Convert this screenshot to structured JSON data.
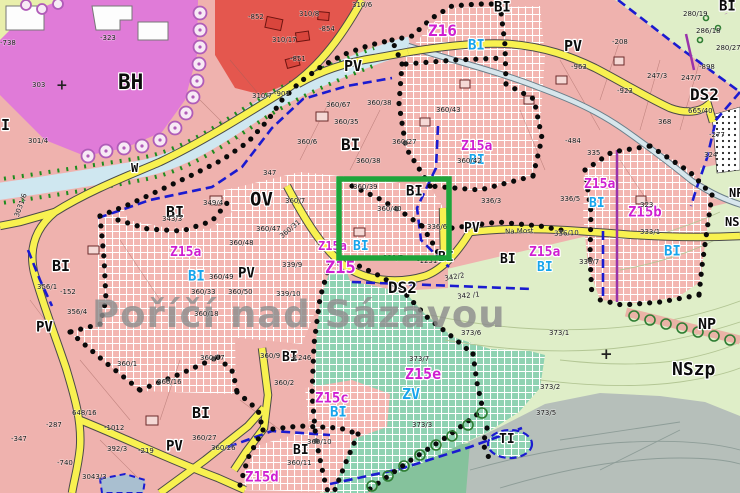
{
  "town_name": "Poříčí nad Sázavou",
  "colors": {
    "residential_pink": "#efb2ae",
    "development_hatch_pink": "#f3b6b1",
    "mixed_red": "#e4574e",
    "civic_violet": "#e07bd8",
    "greenery_teal_hatch": "#8fd2b2",
    "landscape_light_green": "#dfeec8",
    "forest_gray": "#b6bfba",
    "meadow_sage": "#85c29c",
    "road_yellow": "#f8f150",
    "water_blue": "#cfe7f0",
    "boundary_blue": "#1b1bd0",
    "boundary_purple": "#9933aa",
    "boundary_black_dots": "#0a0a0a",
    "label_magenta": "#cf1fd1",
    "label_cyan": "#17a5ec",
    "highlight_green": "#1ea53b",
    "town_name_gray": "#8e8e8e"
  },
  "highlight": {
    "x": 339,
    "y": 179,
    "width": 110,
    "height": 79
  },
  "labels": {
    "zones": [
      {
        "t": "OV",
        "x": 250,
        "y": 192,
        "s": 19
      },
      {
        "t": "BH",
        "x": 118,
        "y": 74,
        "s": 21
      },
      {
        "t": "BI",
        "x": 341,
        "y": 138,
        "s": 16
      },
      {
        "t": "BI",
        "x": 166,
        "y": 206,
        "s": 15
      },
      {
        "t": "BI",
        "x": 52,
        "y": 260,
        "s": 15
      },
      {
        "t": "I",
        "x": 1,
        "y": 119,
        "s": 15
      },
      {
        "t": "BI",
        "x": 719,
        "y": 1,
        "s": 14
      },
      {
        "t": "BI",
        "x": 494,
        "y": 2,
        "s": 14
      },
      {
        "t": "BI",
        "x": 406,
        "y": 186,
        "s": 14
      },
      {
        "t": "BI",
        "x": 438,
        "y": 252,
        "s": 13
      },
      {
        "t": "BI",
        "x": 500,
        "y": 254,
        "s": 13
      },
      {
        "t": "BI",
        "x": 282,
        "y": 352,
        "s": 13
      },
      {
        "t": "BI",
        "x": 192,
        "y": 407,
        "s": 15
      },
      {
        "t": "BI",
        "x": 293,
        "y": 445,
        "s": 13
      },
      {
        "t": "PV",
        "x": 344,
        "y": 60,
        "s": 15
      },
      {
        "t": "PV",
        "x": 564,
        "y": 40,
        "s": 15
      },
      {
        "t": "PV",
        "x": 238,
        "y": 268,
        "s": 14
      },
      {
        "t": "PV",
        "x": 36,
        "y": 322,
        "s": 14
      },
      {
        "t": "PV",
        "x": 464,
        "y": 223,
        "s": 13
      },
      {
        "t": "PV",
        "x": 166,
        "y": 441,
        "s": 14
      },
      {
        "t": "DS2",
        "x": 388,
        "y": 281,
        "s": 16
      },
      {
        "t": "DS2",
        "x": 690,
        "y": 88,
        "s": 16
      },
      {
        "t": "NP",
        "x": 698,
        "y": 318,
        "s": 15
      },
      {
        "t": "NSzp",
        "x": 672,
        "y": 362,
        "s": 18
      },
      {
        "t": "NP",
        "x": 729,
        "y": 188,
        "s": 12
      },
      {
        "t": "NSzp",
        "x": 725,
        "y": 217,
        "s": 12
      },
      {
        "t": "TI",
        "x": 499,
        "y": 434,
        "s": 13
      },
      {
        "t": "W",
        "x": 131,
        "y": 163,
        "s": 12
      }
    ],
    "plans": [
      {
        "t": "Z16",
        "x": 428,
        "y": 24,
        "s": 16
      },
      {
        "t": "Z15a",
        "x": 170,
        "y": 247,
        "s": 13
      },
      {
        "t": "Z15a",
        "x": 461,
        "y": 141,
        "s": 13
      },
      {
        "t": "Z15a",
        "x": 584,
        "y": 179,
        "s": 13
      },
      {
        "t": "Z15a",
        "x": 529,
        "y": 247,
        "s": 13
      },
      {
        "t": "Z15b",
        "x": 628,
        "y": 207,
        "s": 14
      },
      {
        "t": "Z15a",
        "x": 318,
        "y": 241,
        "s": 12
      },
      {
        "t": "Z15",
        "x": 325,
        "y": 261,
        "s": 17
      },
      {
        "t": "Z15c",
        "x": 315,
        "y": 393,
        "s": 14
      },
      {
        "t": "Z15d",
        "x": 245,
        "y": 472,
        "s": 14
      },
      {
        "t": "Z15e",
        "x": 405,
        "y": 368,
        "s": 15
      }
    ],
    "uses": [
      {
        "t": "BI",
        "x": 468,
        "y": 40,
        "s": 14
      },
      {
        "t": "BI",
        "x": 188,
        "y": 271,
        "s": 14
      },
      {
        "t": "BI",
        "x": 469,
        "y": 155,
        "s": 13
      },
      {
        "t": "BI",
        "x": 589,
        "y": 198,
        "s": 13
      },
      {
        "t": "BI",
        "x": 664,
        "y": 246,
        "s": 14
      },
      {
        "t": "BI",
        "x": 537,
        "y": 262,
        "s": 13
      },
      {
        "t": "BI",
        "x": 353,
        "y": 241,
        "s": 13
      },
      {
        "t": "BI",
        "x": 330,
        "y": 407,
        "s": 14
      },
      {
        "t": "ZV",
        "x": 402,
        "y": 388,
        "s": 15
      }
    ],
    "parcels": [
      {
        "t": "303",
        "x": 32,
        "y": 82
      },
      {
        "t": "-323",
        "x": 100,
        "y": 35
      },
      {
        "t": "301/4",
        "x": 28,
        "y": 138
      },
      {
        "t": "-738",
        "x": 0,
        "y": 40
      },
      {
        "t": "310/6",
        "x": 352,
        "y": 2
      },
      {
        "t": "310/8",
        "x": 299,
        "y": 11
      },
      {
        "t": "310/17",
        "x": 272,
        "y": 37
      },
      {
        "t": "-852",
        "x": 248,
        "y": 14
      },
      {
        "t": "-854",
        "x": 319,
        "y": 26
      },
      {
        "t": "-851",
        "x": 290,
        "y": 56
      },
      {
        "t": "-901",
        "x": 274,
        "y": 91
      },
      {
        "t": "310/7",
        "x": 252,
        "y": 93
      },
      {
        "t": "347",
        "x": 263,
        "y": 170
      },
      {
        "t": "360/7",
        "x": 285,
        "y": 198
      },
      {
        "t": "343/3",
        "x": 162,
        "y": 216
      },
      {
        "t": "349/4",
        "x": 203,
        "y": 200
      },
      {
        "t": "360/47",
        "x": 256,
        "y": 226
      },
      {
        "t": "360/48",
        "x": 229,
        "y": 240
      },
      {
        "t": "360/49",
        "x": 209,
        "y": 274
      },
      {
        "t": "360/50",
        "x": 228,
        "y": 289
      },
      {
        "t": "360/33",
        "x": 191,
        "y": 289
      },
      {
        "t": "360/18",
        "x": 194,
        "y": 311
      },
      {
        "t": "339/9",
        "x": 282,
        "y": 262
      },
      {
        "t": "339/10",
        "x": 276,
        "y": 291
      },
      {
        "t": "360/31",
        "x": 279,
        "y": 235,
        "r": -40
      },
      {
        "t": "3031/6",
        "x": 14,
        "y": 216,
        "r": -70
      },
      {
        "t": "360/67",
        "x": 326,
        "y": 102
      },
      {
        "t": "360/38",
        "x": 367,
        "y": 100
      },
      {
        "t": "360/35",
        "x": 334,
        "y": 119
      },
      {
        "t": "360/6",
        "x": 297,
        "y": 139
      },
      {
        "t": "360/27",
        "x": 392,
        "y": 139
      },
      {
        "t": "360/38",
        "x": 356,
        "y": 158
      },
      {
        "t": "360/43",
        "x": 436,
        "y": 107
      },
      {
        "t": "360/42",
        "x": 457,
        "y": 158
      },
      {
        "t": "360/40",
        "x": 377,
        "y": 206
      },
      {
        "t": "360/39",
        "x": 353,
        "y": 184
      },
      {
        "t": "336/6",
        "x": 427,
        "y": 224
      },
      {
        "t": "336/3",
        "x": 481,
        "y": 198
      },
      {
        "t": "335",
        "x": 587,
        "y": 150
      },
      {
        "t": "-963",
        "x": 571,
        "y": 64
      },
      {
        "t": "-208",
        "x": 612,
        "y": 39
      },
      {
        "t": "-923",
        "x": 617,
        "y": 88
      },
      {
        "t": "368",
        "x": 658,
        "y": 119
      },
      {
        "t": "-484",
        "x": 565,
        "y": 138
      },
      {
        "t": "336/5",
        "x": 560,
        "y": 196
      },
      {
        "t": "336/7",
        "x": 579,
        "y": 259
      },
      {
        "t": "323",
        "x": 640,
        "y": 202
      },
      {
        "t": "333/1",
        "x": 640,
        "y": 229
      },
      {
        "t": "280/19",
        "x": 683,
        "y": 11
      },
      {
        "t": "286/18",
        "x": 696,
        "y": 28
      },
      {
        "t": "280/27",
        "x": 716,
        "y": 45
      },
      {
        "t": "247/3",
        "x": 647,
        "y": 73
      },
      {
        "t": "247/7",
        "x": 681,
        "y": 75
      },
      {
        "t": "-898",
        "x": 699,
        "y": 64
      },
      {
        "t": "665/40",
        "x": 688,
        "y": 108
      },
      {
        "t": "-277",
        "x": 709,
        "y": 132
      },
      {
        "t": "324",
        "x": 704,
        "y": 152
      },
      {
        "t": "342/2",
        "x": 444,
        "y": 276,
        "r": -10
      },
      {
        "t": "342 /1",
        "x": 457,
        "y": 294,
        "r": -6
      },
      {
        "t": "339/7",
        "x": 383,
        "y": 255
      },
      {
        "t": "-1231",
        "x": 417,
        "y": 258
      },
      {
        "t": "373/6",
        "x": 461,
        "y": 330
      },
      {
        "t": "373/7",
        "x": 409,
        "y": 356
      },
      {
        "t": "373/1",
        "x": 549,
        "y": 330
      },
      {
        "t": "373/2",
        "x": 540,
        "y": 384
      },
      {
        "t": "373/5",
        "x": 536,
        "y": 410
      },
      {
        "t": "373/3",
        "x": 412,
        "y": 422
      },
      {
        "t": "336/10",
        "x": 554,
        "y": 231,
        "r": -2
      },
      {
        "t": "Na Most",
        "x": 505,
        "y": 229,
        "r": -2
      },
      {
        "t": "356/1",
        "x": 37,
        "y": 284
      },
      {
        "t": "-152",
        "x": 60,
        "y": 289
      },
      {
        "t": "356/4",
        "x": 67,
        "y": 309
      },
      {
        "t": "360/1",
        "x": 117,
        "y": 361
      },
      {
        "t": "360/17",
        "x": 200,
        "y": 355
      },
      {
        "t": "360/16",
        "x": 157,
        "y": 379
      },
      {
        "t": "360/27",
        "x": 192,
        "y": 435
      },
      {
        "t": "360/26",
        "x": 211,
        "y": 445
      },
      {
        "t": "-1012",
        "x": 104,
        "y": 425
      },
      {
        "t": "392/3",
        "x": 107,
        "y": 446
      },
      {
        "t": "-219",
        "x": 138,
        "y": 448
      },
      {
        "t": "-740",
        "x": 57,
        "y": 460
      },
      {
        "t": "-287",
        "x": 46,
        "y": 422
      },
      {
        "t": "-347",
        "x": 11,
        "y": 436
      },
      {
        "t": "3043/3",
        "x": 82,
        "y": 474
      },
      {
        "t": "648/16",
        "x": 72,
        "y": 410
      },
      {
        "t": "360/9",
        "x": 260,
        "y": 353
      },
      {
        "t": "-1246",
        "x": 291,
        "y": 355
      },
      {
        "t": "360/2",
        "x": 274,
        "y": 380
      },
      {
        "t": "360/10",
        "x": 307,
        "y": 439
      },
      {
        "t": "360/11",
        "x": 287,
        "y": 460
      }
    ],
    "marks": [
      {
        "t": "+",
        "x": 56,
        "y": 80,
        "s": 14
      },
      {
        "t": "+",
        "x": 600,
        "y": 348,
        "s": 15
      }
    ]
  }
}
